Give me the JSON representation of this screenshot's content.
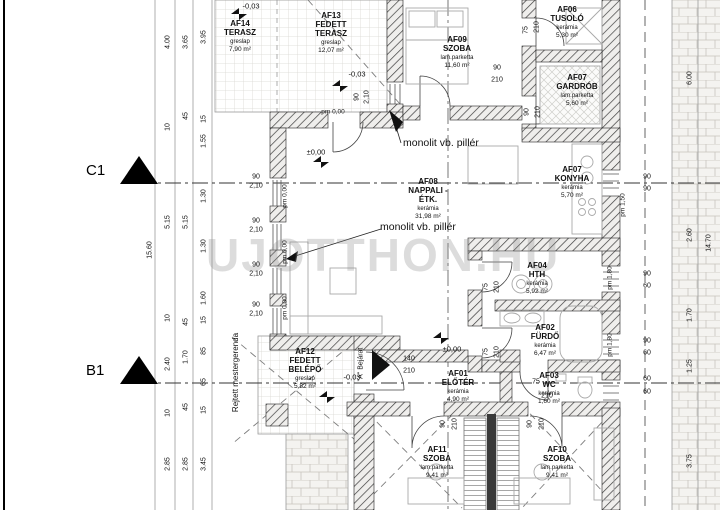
{
  "plan": {
    "watermark": "UJOTTHON.HU",
    "axes": [
      {
        "label": "C1"
      },
      {
        "label": "B1"
      }
    ],
    "notes": {
      "pillar1": "monolit vb. pillér",
      "pillar2": "monolit vb. pillér",
      "hidden_beam": "Rejtett mestergerenda",
      "entrance": "\"A\" Bejárat"
    },
    "rooms": [
      {
        "id": "AF14",
        "name": "TERASZ",
        "finish": "greslap",
        "area": "7,90 m²"
      },
      {
        "id": "AF13",
        "name": "FEDETT TERASZ",
        "finish": "greslap",
        "area": "12,07 m²"
      },
      {
        "id": "AF09",
        "name": "SZOBA",
        "finish": "lam.parketta",
        "area": "11,60 m²"
      },
      {
        "id": "AF06",
        "name": "TUSOLÓ",
        "finish": "kerámia",
        "area": "5,30 m²"
      },
      {
        "id": "AF07",
        "name": "GARDRÓB",
        "finish": "lam.parketta",
        "area": "5,60 m²"
      },
      {
        "id": "AF08",
        "name": "NAPPALI - ÉTK.",
        "finish": "kerámia",
        "area": "31,98 m²"
      },
      {
        "id": "AF07",
        "name": "KONYHA",
        "finish": "kerámia",
        "area": "5,70 m²"
      },
      {
        "id": "AF04",
        "name": "HTH",
        "finish": "kerámia",
        "area": "5,92 m²"
      },
      {
        "id": "AF02",
        "name": "FÜRDŐ",
        "finish": "kerámia",
        "area": "6,47 m²"
      },
      {
        "id": "AF12",
        "name": "FEDETT BELÉPŐ",
        "finish": "greslap",
        "area": "5,82 m²"
      },
      {
        "id": "AF01",
        "name": "ELŐTÉR",
        "finish": "kerámia",
        "area": "4,90 m²"
      },
      {
        "id": "AF03",
        "name": "WC",
        "finish": "kerámia",
        "area": "1,60 m²"
      },
      {
        "id": "AF11",
        "name": "SZOBA",
        "finish": "lam.parketta",
        "area": "9,41 m²"
      },
      {
        "id": "AF10",
        "name": "SZOBA",
        "finish": "lam.parketta",
        "area": "9,41 m²"
      }
    ],
    "dims": [
      [
        "15.60",
        150,
        250,
        1,
        "dim"
      ],
      [
        "4.00",
        168,
        42,
        1,
        "dim"
      ],
      [
        "10",
        168,
        127,
        1,
        "dim"
      ],
      [
        "5.15",
        168,
        222,
        1,
        "dim"
      ],
      [
        "10",
        168,
        318,
        1,
        "dim"
      ],
      [
        "2.40",
        168,
        364,
        1,
        "dim"
      ],
      [
        "10",
        168,
        413,
        1,
        "dim"
      ],
      [
        "2.85",
        168,
        464,
        1,
        "dim"
      ],
      [
        "3.65",
        186,
        42,
        1,
        "dim"
      ],
      [
        "45",
        186,
        116,
        1,
        "dim"
      ],
      [
        "5.15",
        186,
        222,
        1,
        "dim"
      ],
      [
        "45",
        186,
        322,
        1,
        "dim"
      ],
      [
        "1.70",
        186,
        357,
        1,
        "dim"
      ],
      [
        "45",
        186,
        407,
        1,
        "dim"
      ],
      [
        "2.85",
        186,
        464,
        1,
        "dim"
      ],
      [
        "3.95",
        204,
        37,
        1,
        "dim"
      ],
      [
        "15",
        204,
        119,
        1,
        "dim"
      ],
      [
        "1.55",
        204,
        141,
        1,
        "dim"
      ],
      [
        "1.30",
        204,
        196,
        1,
        "dim"
      ],
      [
        "1.30",
        204,
        246,
        1,
        "dim"
      ],
      [
        "1.60",
        204,
        298,
        1,
        "dim"
      ],
      [
        "15",
        204,
        320,
        1,
        "dim"
      ],
      [
        "85",
        204,
        351,
        1,
        "dim"
      ],
      [
        "65",
        204,
        382,
        1,
        "dim"
      ],
      [
        "15",
        204,
        410,
        1,
        "dim"
      ],
      [
        "3.45",
        204,
        464,
        1,
        "dim"
      ],
      [
        "6.00",
        690,
        78,
        1,
        "dim"
      ],
      [
        "2.60",
        690,
        235,
        1,
        "dim"
      ],
      [
        "1.70",
        690,
        315,
        1,
        "dim"
      ],
      [
        "1.25",
        690,
        366,
        1,
        "dim"
      ],
      [
        "3.75",
        690,
        461,
        1,
        "dim"
      ],
      [
        "14.70",
        709,
        243,
        1,
        "dim"
      ],
      [
        "90",
        357,
        97,
        1,
        "dim"
      ],
      [
        "2,10",
        367,
        97,
        1,
        "dim"
      ],
      [
        "90",
        497,
        68,
        0,
        "dim"
      ],
      [
        "210",
        497,
        80,
        0,
        "dim"
      ],
      [
        "75",
        526,
        30,
        1,
        "dim"
      ],
      [
        "210",
        537,
        27,
        1,
        "dim"
      ],
      [
        "90",
        527,
        112,
        1,
        "dim"
      ],
      [
        "210",
        538,
        112,
        1,
        "dim"
      ],
      [
        "90",
        256,
        177,
        0,
        "dim"
      ],
      [
        "2,10",
        256,
        186,
        0,
        "dim"
      ],
      [
        "90",
        256,
        221,
        0,
        "dim"
      ],
      [
        "2,10",
        256,
        230,
        0,
        "dim"
      ],
      [
        "90",
        256,
        265,
        0,
        "dim"
      ],
      [
        "2,10",
        256,
        274,
        0,
        "dim"
      ],
      [
        "90",
        256,
        305,
        0,
        "dim"
      ],
      [
        "2,10",
        256,
        314,
        0,
        "dim"
      ],
      [
        "90",
        647,
        177,
        0,
        "dim"
      ],
      [
        "90",
        647,
        189,
        0,
        "dim"
      ],
      [
        "90",
        647,
        274,
        0,
        "dim"
      ],
      [
        "60",
        647,
        286,
        0,
        "dim"
      ],
      [
        "90",
        647,
        341,
        0,
        "dim"
      ],
      [
        "60",
        647,
        353,
        0,
        "dim"
      ],
      [
        "60",
        647,
        379,
        0,
        "dim"
      ],
      [
        "60",
        647,
        392,
        0,
        "dim"
      ],
      [
        "75",
        486,
        287,
        1,
        "dim"
      ],
      [
        "210",
        497,
        287,
        1,
        "dim"
      ],
      [
        "75",
        486,
        352,
        1,
        "dim"
      ],
      [
        "210",
        497,
        352,
        1,
        "dim"
      ],
      [
        "75",
        536,
        382,
        0,
        "dim"
      ],
      [
        "210",
        547,
        396,
        0,
        "dim"
      ],
      [
        "140",
        409,
        359,
        0,
        "dim"
      ],
      [
        "210",
        409,
        371,
        0,
        "dim"
      ],
      [
        "90",
        443,
        424,
        1,
        "dim"
      ],
      [
        "210",
        455,
        424,
        1,
        "dim"
      ],
      [
        "90",
        530,
        424,
        1,
        "dim"
      ],
      [
        "210",
        542,
        424,
        1,
        "dim"
      ],
      [
        "pm 0,00",
        285,
        196,
        1,
        "pm"
      ],
      [
        "pm 0,00",
        285,
        252,
        1,
        "pm"
      ],
      [
        "pm 0,00",
        285,
        308,
        1,
        "pm"
      ],
      [
        "pm 0,00",
        333,
        112,
        0,
        "pm"
      ],
      [
        "pm 1,50",
        623,
        205,
        1,
        "pm"
      ],
      [
        "pm 1,80",
        610,
        278,
        1,
        "pm"
      ],
      [
        "pm 1,80",
        610,
        345,
        1,
        "pm"
      ],
      [
        "-0,03",
        251,
        6,
        0,
        "level"
      ],
      [
        "-0,03",
        357,
        74,
        0,
        "level"
      ],
      [
        "-0,03",
        352,
        377,
        0,
        "level"
      ],
      [
        "±0,00",
        316,
        152,
        0,
        "level"
      ],
      [
        "±0,00",
        452,
        349,
        0,
        "level"
      ]
    ]
  }
}
